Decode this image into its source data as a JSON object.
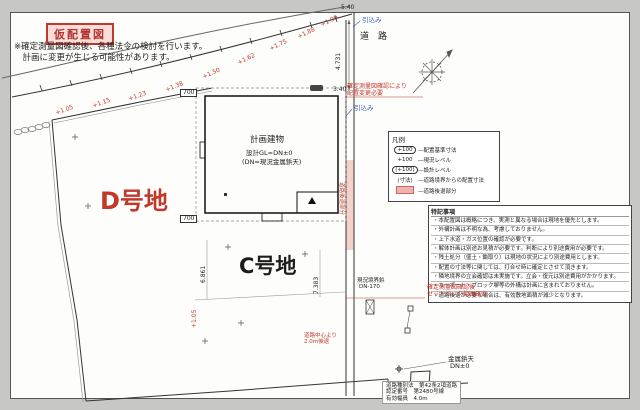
{
  "colors": {
    "red": "#c0392b",
    "blue": "#2e5fb7",
    "pink": "#f0b4ac",
    "sheet": "#fdfdfb",
    "bg": "#c7c7c5"
  },
  "title": {
    "label": "仮配置図"
  },
  "header_note": {
    "line1": "※確定測量図確認後、各種法令の検討を行います。",
    "line2": "　計画に変更が生じる可能性があります。"
  },
  "legend": {
    "title": "凡例",
    "rows": [
      {
        "sym": "+100",
        "style": "oval",
        "label": "―配置基準寸法"
      },
      {
        "sym": "+100",
        "style": "plain",
        "label": "―現況レベル"
      },
      {
        "sym": "(+100)",
        "style": "oval",
        "label": "―設計レベル"
      },
      {
        "sym": "(寸法)",
        "style": "plain",
        "label": "―道路境界からの配置寸法"
      },
      {
        "sym": "",
        "style": "swatch",
        "label": "―道路後退部分"
      }
    ]
  },
  "notes": {
    "title": "特記事項",
    "rows": [
      "・本配置図は概略につき、実測と異なる場合は現地を優先とします。",
      "・外構計画は不明な為、考慮しておりません。",
      "・上下水道・ガス位置の確認が必要です。",
      "・解体計画は別途お見積が必要です。判断により別途費用が必要です。",
      "・残土処分（盛土・鋤取り）は現地の状況により別途費用とします。",
      "・配置の寸法等に関しては、打合せ時に確定とさせて頂きます。",
      "・隣地境界の立会確認は未実施です。立会・復元は別途費用がかかります。",
      "・カーポート・ブロック塀等の外構は計画に含まれておりません。",
      "・道路後退が必要な場合は、有効敷地面積が減少となります。"
    ]
  },
  "road_info": {
    "line1": "道路種別法　第42条2項道路",
    "line2": "認定番号　第2480号線",
    "line3": "有効幅員　4.0m"
  },
  "labels": [
    {
      "name": "level-mark",
      "text": "+1.05",
      "x": 55,
      "y": 111,
      "size": 6,
      "color": "red",
      "rot": -20
    },
    {
      "name": "level-mark",
      "text": "+1.15",
      "x": 92,
      "y": 104,
      "size": 6,
      "color": "red",
      "rot": -20
    },
    {
      "name": "level-mark",
      "text": "+1.23",
      "x": 128,
      "y": 97,
      "size": 6,
      "color": "red",
      "rot": -20
    },
    {
      "name": "level-mark",
      "text": "+1.38",
      "x": 165,
      "y": 88,
      "size": 6,
      "color": "red",
      "rot": -22
    },
    {
      "name": "level-mark",
      "text": "+1.50",
      "x": 202,
      "y": 75,
      "size": 6,
      "color": "red",
      "rot": -24
    },
    {
      "name": "level-mark",
      "text": "+1.62",
      "x": 237,
      "y": 61,
      "size": 6,
      "color": "red",
      "rot": -26
    },
    {
      "name": "level-mark",
      "text": "+1.75",
      "x": 269,
      "y": 47,
      "size": 6,
      "color": "red",
      "rot": -26
    },
    {
      "name": "level-mark",
      "text": "+1.88",
      "x": 297,
      "y": 35,
      "size": 6,
      "color": "red",
      "rot": -26
    },
    {
      "name": "level-mark",
      "text": "+1.99",
      "x": 320,
      "y": 23,
      "size": 6,
      "color": "red",
      "rot": -26
    },
    {
      "name": "road-label",
      "text": "道　路",
      "x": 360,
      "y": 33,
      "size": 9,
      "color": "black"
    },
    {
      "name": "dim-top",
      "text": "5.40",
      "x": 341,
      "y": 5,
      "size": 6,
      "color": "black"
    },
    {
      "name": "dim-corner",
      "text": "3.40",
      "x": 333,
      "y": 87,
      "size": 6,
      "color": "black"
    },
    {
      "name": "service-in-label",
      "text": "引込み",
      "x": 362,
      "y": 17,
      "size": 6.5,
      "color": "blue"
    },
    {
      "name": "service-in-label",
      "text": "引込み",
      "x": 354,
      "y": 105,
      "size": 6.5,
      "color": "blue"
    },
    {
      "name": "survey-annotation",
      "text": "確定測量図確認により",
      "x": 347,
      "y": 84,
      "size": 6,
      "color": "red"
    },
    {
      "name": "survey-annotation",
      "text": "配置変更必要",
      "x": 347,
      "y": 91,
      "size": 6,
      "color": "red"
    },
    {
      "name": "setback-annotation",
      "text": "確定測量図確認後",
      "x": 427,
      "y": 285,
      "size": 6,
      "color": "red"
    },
    {
      "name": "setback-annotation",
      "text": "セットバック範囲確定",
      "x": 427,
      "y": 292,
      "size": 6,
      "color": "red"
    },
    {
      "name": "center-setback-annotation",
      "text": "道路中心より",
      "x": 304,
      "y": 334,
      "size": 5.5,
      "color": "red"
    },
    {
      "name": "center-setback-annotation",
      "text": "2.0m後退",
      "x": 304,
      "y": 340,
      "size": 5.5,
      "color": "red"
    },
    {
      "name": "benchmark-label",
      "text": "金属鋲天",
      "x": 448,
      "y": 356,
      "size": 6.5,
      "color": "black"
    },
    {
      "name": "benchmark-label",
      "text": "DN±0",
      "x": 450,
      "y": 363,
      "size": 6.5,
      "color": "black"
    },
    {
      "name": "boundary-pin-label",
      "text": "現況境界鋲",
      "x": 357,
      "y": 279,
      "size": 5.5,
      "color": "black"
    },
    {
      "name": "boundary-pin-label",
      "text": "DN-170",
      "x": 359,
      "y": 285,
      "size": 5.5,
      "color": "black"
    },
    {
      "name": "parcel-d-label",
      "text": "D号地",
      "x": 100,
      "y": 189,
      "size": 24,
      "color": "red",
      "bold": true
    },
    {
      "name": "parcel-c-label",
      "text": "C号地",
      "x": 239,
      "y": 255,
      "size": 21,
      "color": "black",
      "bold": true
    },
    {
      "name": "building-name",
      "text": "計画建物",
      "x": 250,
      "y": 136,
      "size": 8.5,
      "color": "black"
    },
    {
      "name": "building-gl",
      "text": "設計GL=DN±0",
      "x": 246,
      "y": 150,
      "size": 6.5,
      "color": "black"
    },
    {
      "name": "building-datum",
      "text": "(DN=現況金属鋲天)",
      "x": 242,
      "y": 159,
      "size": 6.5,
      "color": "black"
    },
    {
      "name": "offset-dim",
      "text": "700",
      "x": 180,
      "y": 89,
      "size": 6,
      "color": "black",
      "boxed": true
    },
    {
      "name": "offset-dim",
      "text": "700",
      "x": 180,
      "y": 215,
      "size": 6,
      "color": "black",
      "boxed": true
    },
    {
      "name": "road-dim",
      "text": "4.731",
      "x": 336,
      "y": 70,
      "size": 6,
      "color": "black",
      "rot": -90
    },
    {
      "name": "lot-dim",
      "text": "6.861",
      "x": 201,
      "y": 283,
      "size": 6,
      "color": "black",
      "rot": -90
    },
    {
      "name": "lot-dim",
      "text": "7.383",
      "x": 314,
      "y": 294,
      "size": 6,
      "color": "black",
      "rot": -90
    },
    {
      "name": "level-dim",
      "text": "+1.05",
      "x": 192,
      "y": 328,
      "size": 6,
      "color": "red",
      "rot": -90
    },
    {
      "name": "setback-strip-label",
      "text": "道路後退部分",
      "x": 343,
      "y": 182,
      "size": 5.5,
      "color": "red",
      "rot": 90
    }
  ]
}
